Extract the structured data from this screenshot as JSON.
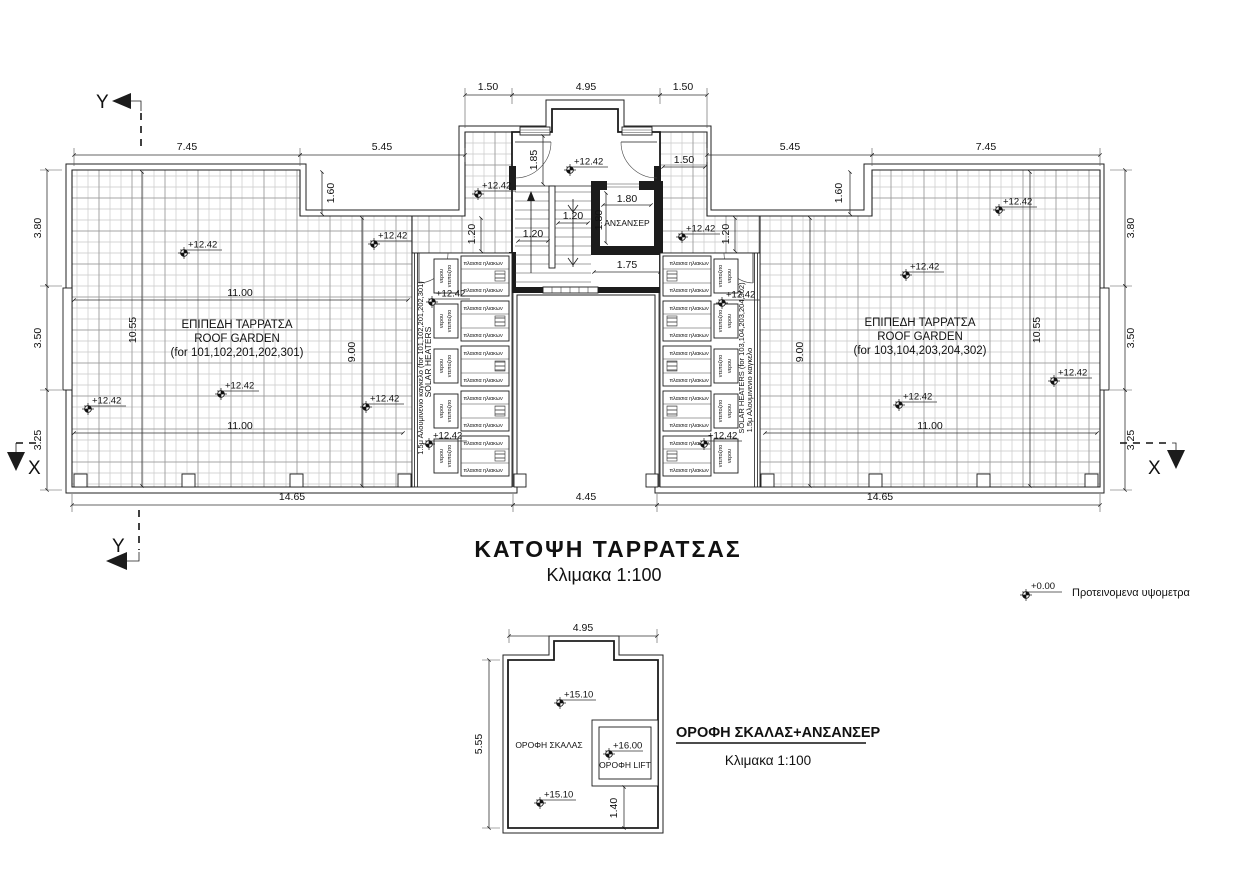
{
  "plan": {
    "title": "ΚΑΤΟΨΗ ΤΑΡΡΑΤΣΑΣ",
    "scale": "Κλιμακα 1:100",
    "left_garden": {
      "line1": "ΕΠΙΠΕΔΗ ΤΑΡΡΑΤΣΑ",
      "line2": "ROOF GARDEN",
      "line3": "(for 101,102,201,202,301)"
    },
    "right_garden": {
      "line1": "ΕΠΙΠΕΔΗ ΤΑΡΡΑΤΣΑ",
      "line2": "ROOF GARDEN",
      "line3": "(for 103,104,203,204,302)"
    },
    "elevator": "ΑΝΣΑΝΣΕΡ",
    "solar_left": {
      "heaters": "SOLAR HEATERS",
      "railing": "1.5μ Αλουμινενιο καγκελο (for 101,102,201,202,301)"
    },
    "solar_right": {
      "heaters": "SOLAR HEATERS (for 103,104,203,204,302)",
      "railing": "1.5μ Αλουμινενιο καγκελο"
    },
    "panel_label": "πλαισια ηλιακων",
    "tank": {
      "left1": "νερου",
      "left2": "ντεποζιτο",
      "right1": "ντεποζιτο",
      "right2": "νερου"
    },
    "roof_elevation": "+12.42"
  },
  "detail": {
    "title": "ΟΡΟΦΗ ΣΚΑΛΑΣ+ΑΝΣΑΝΣΕΡ",
    "scale": "Κλιμακα 1:100",
    "stair_label": "ΟΡΟΦΗ ΣΚΑΛΑΣ",
    "lift_label": "ΟΡΟΦΗ LIFT",
    "stair_elevation": "+15.10",
    "lift_elevation": "+16.00"
  },
  "legend": {
    "elevation": "+0.00",
    "label": "Προτεινομενα υψομετρα"
  },
  "axes": {
    "x": "X",
    "y": "Y"
  },
  "dims": {
    "m120": "1.20",
    "m140": "1.40",
    "m150": "1.50",
    "m160": "1.60",
    "m175": "1.75",
    "m180": "1.80",
    "m185": "1.85",
    "m325": "3.25",
    "m350": "3.50",
    "m380": "3.80",
    "m445": "4.45",
    "m495": "4.95",
    "m545": "5.45",
    "m555": "5.55",
    "m745": "7.45",
    "m900": "9.00",
    "m1055": "10.55",
    "m1100": "11.00",
    "m1465": "14.65"
  }
}
